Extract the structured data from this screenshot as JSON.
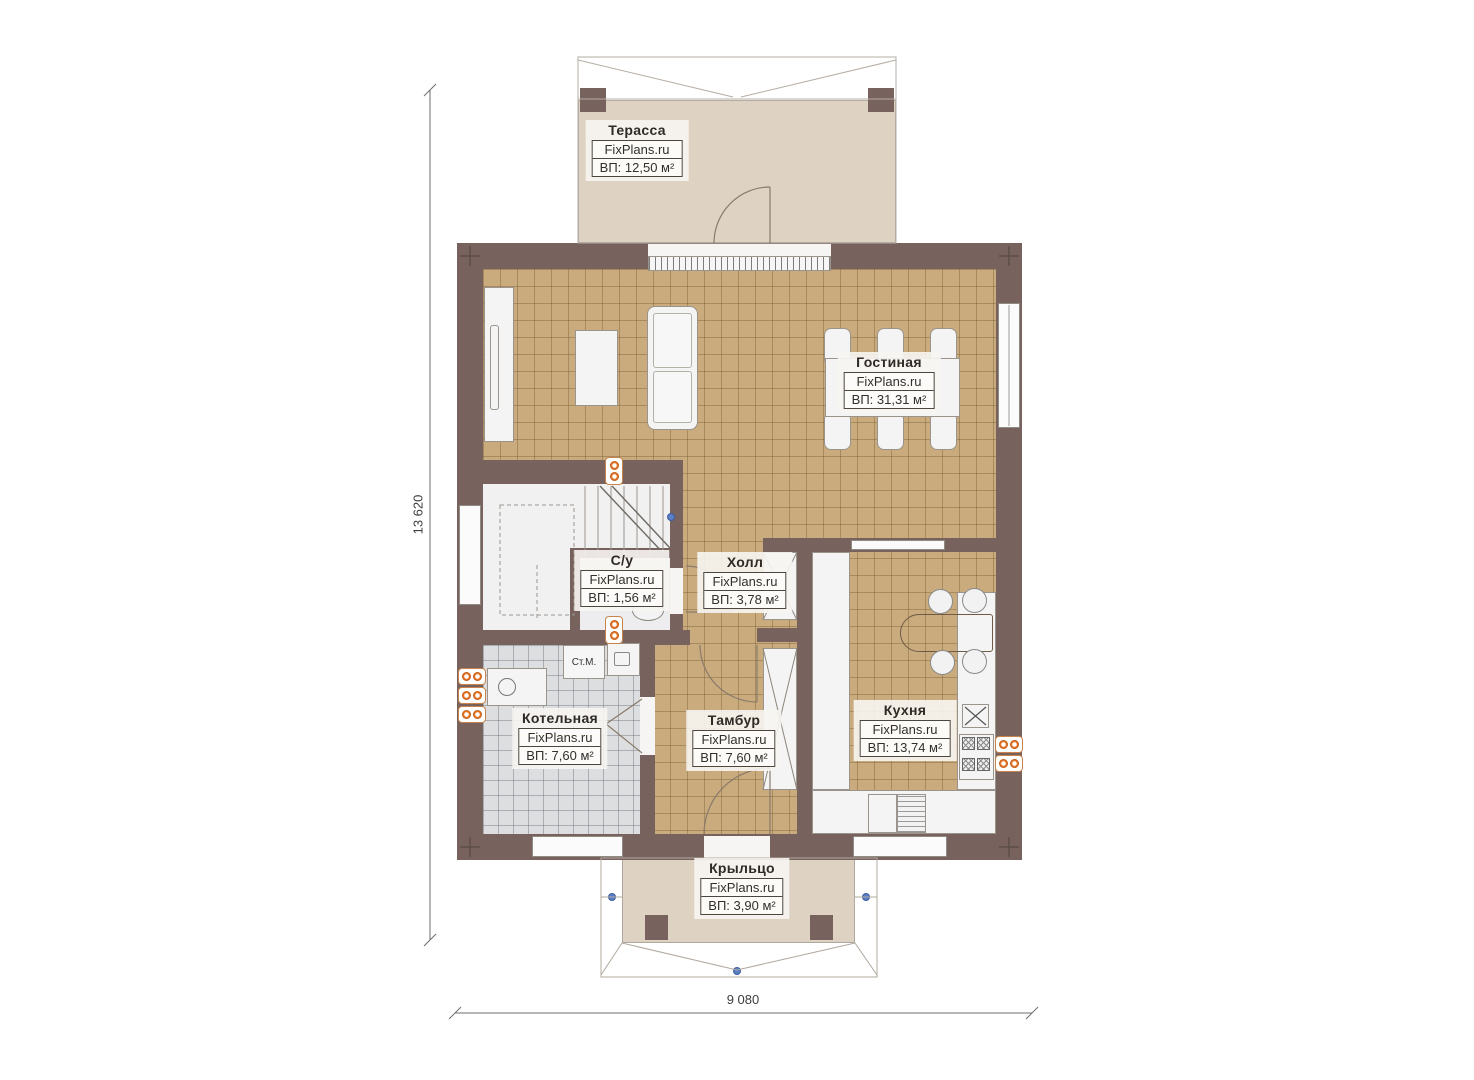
{
  "brand": "FixPlans.ru",
  "rooms": [
    {
      "name": "Терасса",
      "area": "ВП: 12,50 м²"
    },
    {
      "name": "Гостиная",
      "area": "ВП: 31,31 м²"
    },
    {
      "name": "С/у",
      "area": "ВП: 1,56 м²"
    },
    {
      "name": "Холл",
      "area": "ВП: 3,78 м²"
    },
    {
      "name": "Котельная",
      "area": "ВП: 7,60 м²"
    },
    {
      "name": "Тамбур",
      "area": "ВП: 7,60 м²"
    },
    {
      "name": "Кухня",
      "area": "ВП: 13,74 м²"
    },
    {
      "name": "Крыльцо",
      "area": "ВП: 3,90 м²"
    }
  ],
  "annotations": {
    "washing_machine": "Ст.М."
  },
  "dimensions": {
    "vertical": "13 620",
    "horizontal": "9 080"
  },
  "colors": {
    "wall": "#77625d",
    "tile_tan": "#c9ab7d",
    "tile_gray": "#dcdee0",
    "deck": "#ded3c3",
    "radiator_orange": "#e8772a",
    "marker_blue": "#5b7fc4"
  }
}
